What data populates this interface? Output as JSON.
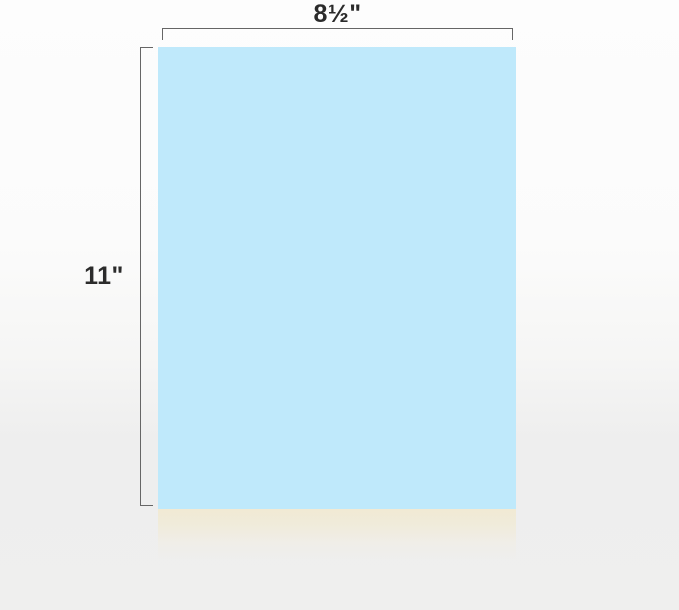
{
  "diagram": {
    "width_label": "8½\"",
    "height_label": "11\"",
    "colors": {
      "sheet": "#bfe9fb",
      "stack_edge": "#f1ead2",
      "dimension_line": "#666666",
      "label_text": "#2b2b2b",
      "background_top": "#fdfdfd",
      "background_bottom": "#eeeeee"
    }
  }
}
